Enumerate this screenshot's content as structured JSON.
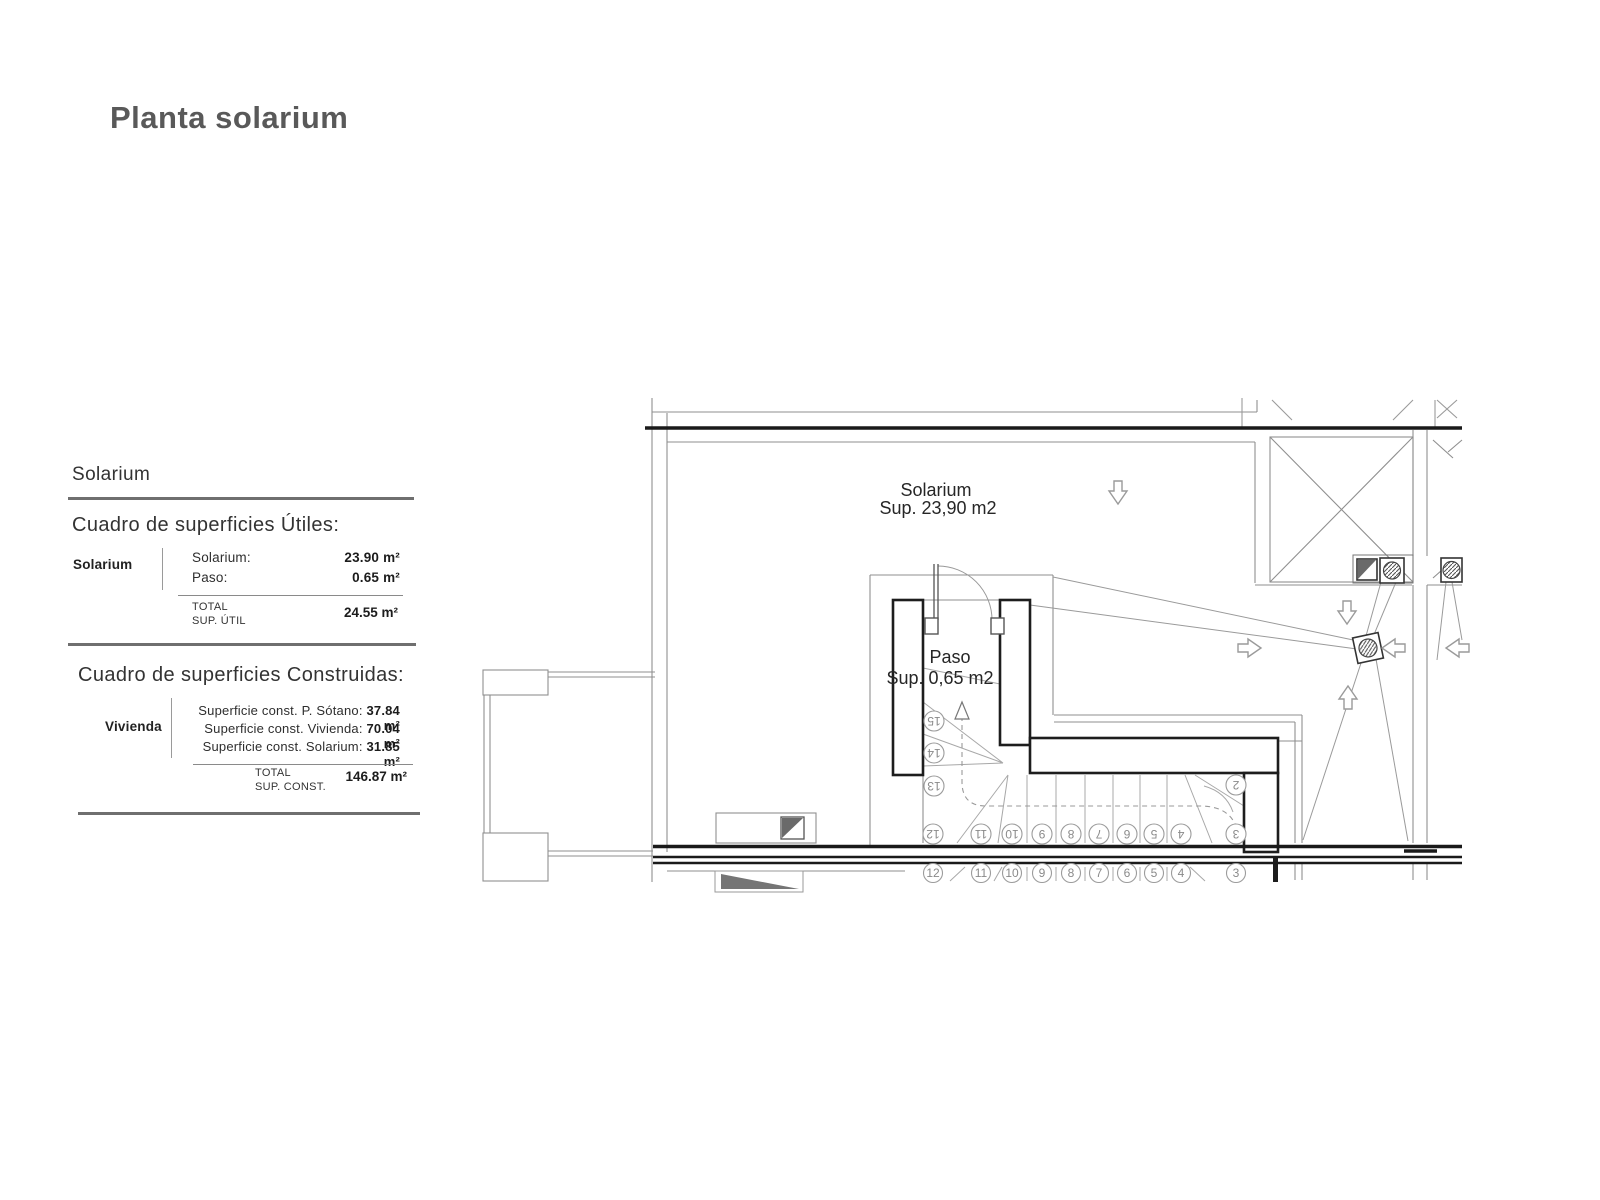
{
  "page": {
    "title": "Planta solarium"
  },
  "tables": {
    "utiles": {
      "heading": "Solarium",
      "title": "Cuadro de superficies Útiles:",
      "row_label": "Solarium",
      "items": [
        {
          "label": "Solarium:",
          "value": "23.90 m²"
        },
        {
          "label": "Paso:",
          "value": "0.65 m²"
        }
      ],
      "total_label_line1": "TOTAL",
      "total_label_line2": "SUP. ÚTIL",
      "total_value": "24.55 m²"
    },
    "construidas": {
      "title": "Cuadro de superficies Construidas:",
      "row_label": "Vivienda",
      "items": [
        {
          "label": "Superficie const. P. Sótano:",
          "value": "37.84 m²"
        },
        {
          "label": "Superficie const. Vivienda:",
          "value": "70.04 m²"
        },
        {
          "label": "Superficie const. Solarium:",
          "value": "31.85 m²"
        }
      ],
      "total_label_line1": "TOTAL",
      "total_label_line2": "SUP. CONST.",
      "total_value": "146.87 m²"
    }
  },
  "plan": {
    "solarium_label": "Solarium",
    "solarium_area": "Sup. 23,90 m2",
    "paso_label": "Paso",
    "paso_area": "Sup. 0,65 m2",
    "upper_step_numbers": [
      "15",
      "14",
      "13",
      "12",
      "11",
      "10",
      "9",
      "8",
      "7",
      "6",
      "5",
      "4",
      "3",
      "2"
    ],
    "lower_step_numbers": [
      "12",
      "11",
      "10",
      "9",
      "8",
      "7",
      "6",
      "5",
      "4",
      "3"
    ],
    "colors": {
      "thin_line": "#8f8f8f",
      "cut_line": "#1a1a1a",
      "symbol_gray": "#6a6a6a"
    }
  }
}
